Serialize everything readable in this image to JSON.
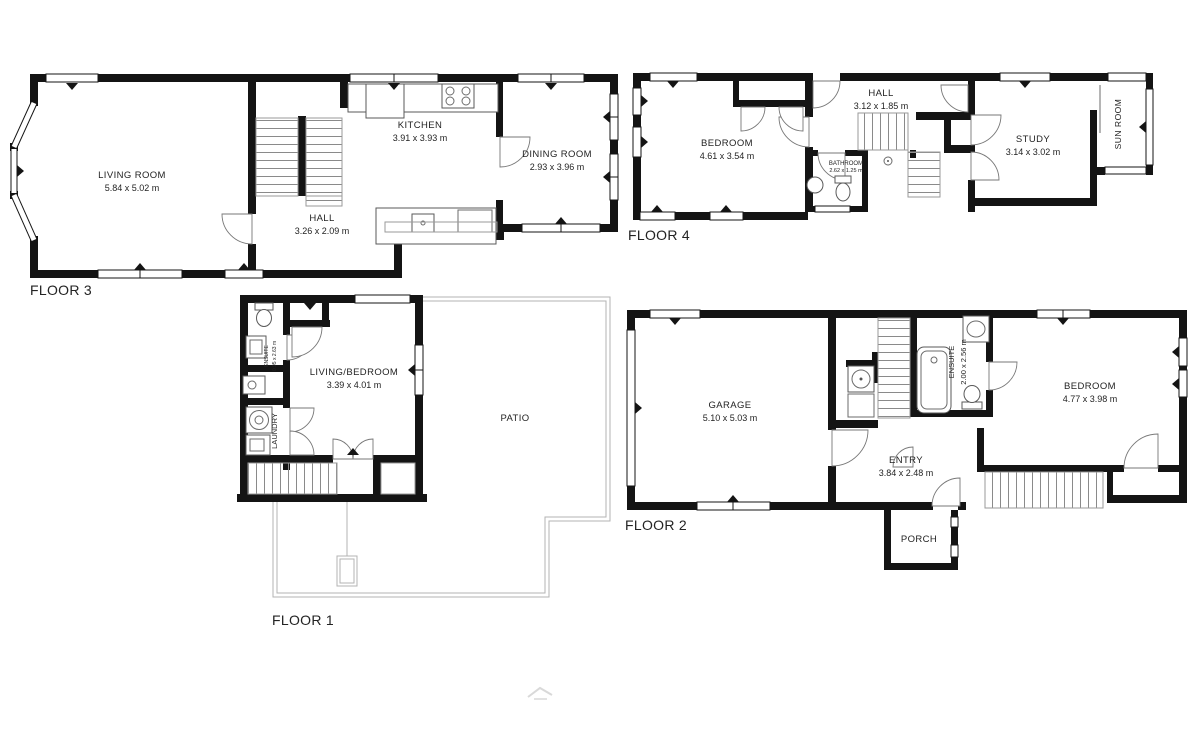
{
  "colors": {
    "wall": "#141414",
    "text": "#232323",
    "stair_lines": "#8a8a8a",
    "patio_line": "#b3b3b3",
    "watermark": "#d9d9d9",
    "background": "#ffffff"
  },
  "floors": {
    "floor3": {
      "label": "FLOOR 3",
      "rooms": {
        "living_room": {
          "name": "LIVING ROOM",
          "dims": "5.84 x 5.02 m"
        },
        "kitchen": {
          "name": "KITCHEN",
          "dims": "3.91 x 3.93 m"
        },
        "dining_room": {
          "name": "DINING ROOM",
          "dims": "2.93 x 3.96 m"
        },
        "hall": {
          "name": "HALL",
          "dims": "3.26 x 2.09 m"
        }
      }
    },
    "floor4": {
      "label": "FLOOR 4",
      "rooms": {
        "bedroom": {
          "name": "BEDROOM",
          "dims": "4.61 x 3.54 m"
        },
        "hall": {
          "name": "HALL",
          "dims": "3.12 x 1.85 m"
        },
        "bathroom": {
          "name": "BATHROOM",
          "dims": "2.62 x 1.25 m"
        },
        "study": {
          "name": "STUDY",
          "dims": "3.14 x 3.02 m"
        },
        "sun_room": {
          "name": "SUN ROOM"
        }
      }
    },
    "floor1": {
      "label": "FLOOR 1",
      "rooms": {
        "living_bedroom": {
          "name": "LIVING/BEDROOM",
          "dims": "3.39 x 4.01 m"
        },
        "ensuite": {
          "name": "ENSUITE",
          "dims": "0.95 x 2.63 m"
        },
        "laundry": {
          "name": "LAUNDRY"
        },
        "patio": {
          "name": "PATIO"
        }
      }
    },
    "floor2": {
      "label": "FLOOR 2",
      "rooms": {
        "garage": {
          "name": "GARAGE",
          "dims": "5.10 x 5.03 m"
        },
        "ensuite": {
          "name": "ENSUITE",
          "dims": "2.00 x 2.56 m"
        },
        "bedroom": {
          "name": "BEDROOM",
          "dims": "4.77 x 3.98 m"
        },
        "entry": {
          "name": "ENTRY",
          "dims": "3.84 x 2.48 m"
        },
        "porch": {
          "name": "PORCH"
        }
      }
    }
  }
}
